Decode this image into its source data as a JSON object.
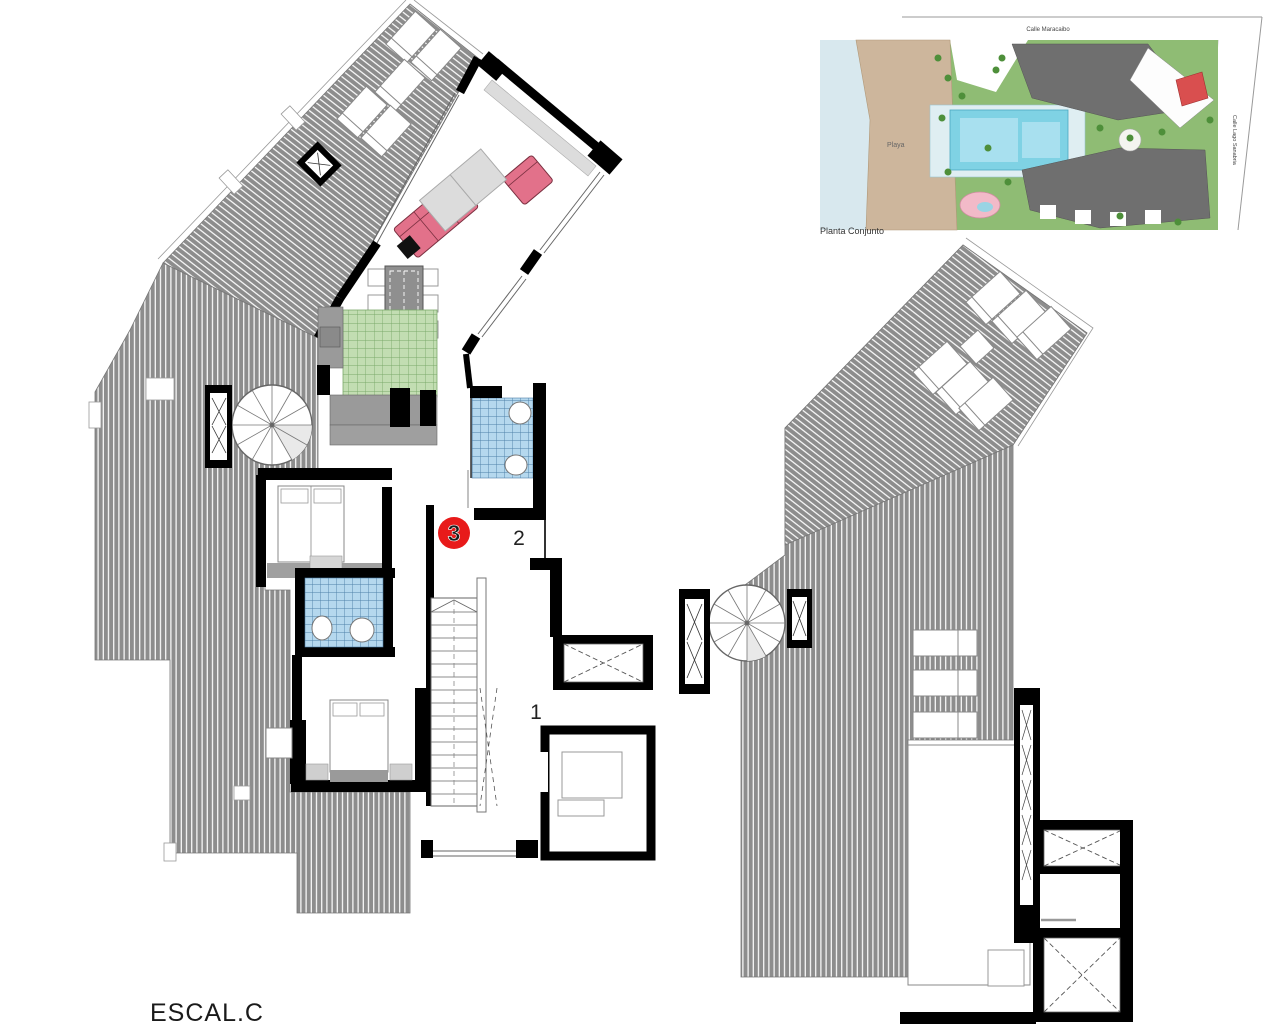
{
  "document": {
    "type": "architectural-floor-plan",
    "description": "Penthouse floor plan with terraces plus site plan inset"
  },
  "labels": {
    "unit_badge": "3",
    "zone_2": "2",
    "zone_1": "1",
    "staircase_name": "ESCAL.C"
  },
  "inset": {
    "caption": "Planta Conjunto",
    "beach": "Playa",
    "street_top": "Calle Maracaibo",
    "street_right": "Calle Lago Sanabria"
  },
  "colors": {
    "terrace_gray": "#8d8d8d",
    "hatch_stripe": "#ffffff",
    "wall_black": "#000000",
    "bath_tile_blue": "#b5d8ee",
    "bath_grid_blue": "#4d7fa8",
    "kitchen_tile_green": "#c2ddb2",
    "kitchen_grid_green": "#7aa96a",
    "sofa_pink": "#e2718a",
    "badge_red": "#e81a1a",
    "sill_gray": "#dcdcdc",
    "counter_gray": "#9a9a9a",
    "beach_sand": "#cdb69c",
    "water_blue": "#d8e8ee",
    "site_green": "#8fbc74",
    "pool_cyan": "#7fd2e4",
    "building_gray": "#6f6f6f",
    "highlight_unit_red": "#d94f4f",
    "spa_pink": "#f2bac8",
    "tree_green": "#4e8f3a"
  }
}
